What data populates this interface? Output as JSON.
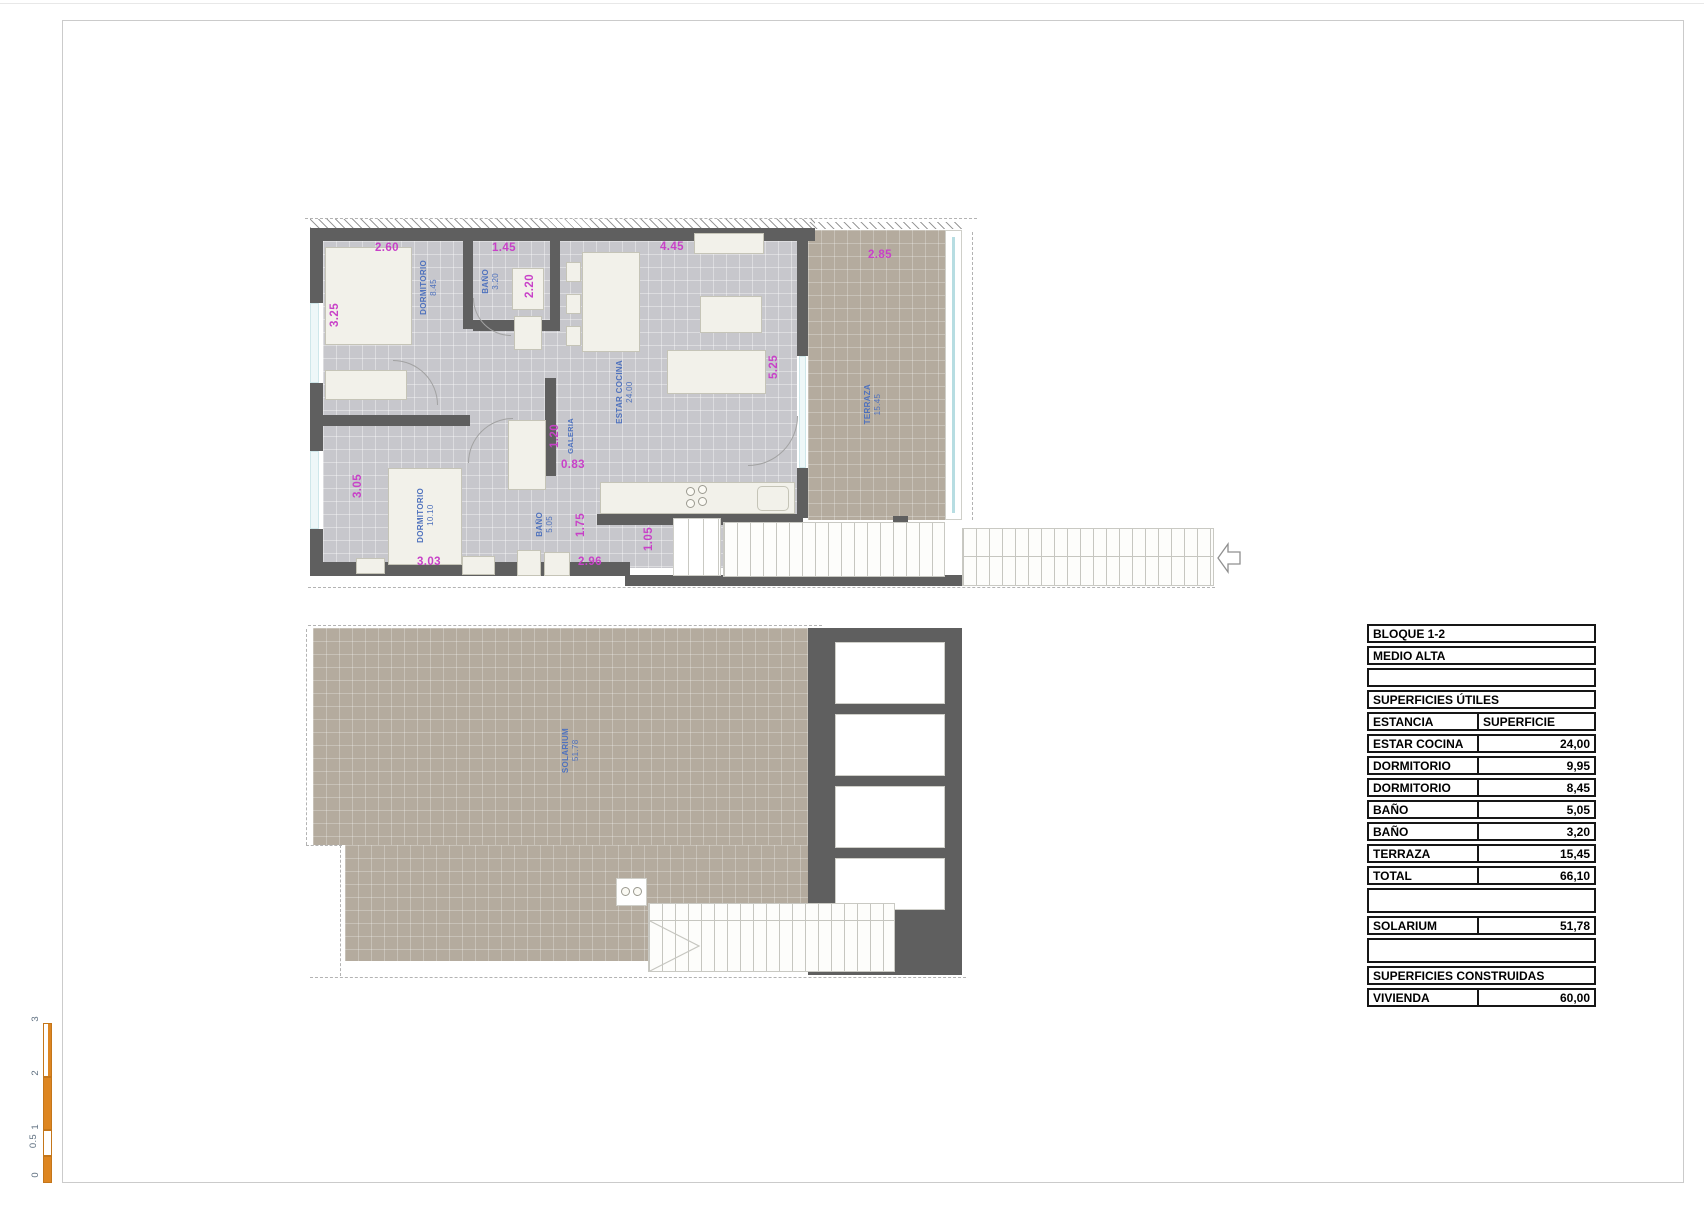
{
  "upper_plan": {
    "dims": {
      "w_dorm1": "2.60",
      "w_bath1": "1.45",
      "w_living": "4.45",
      "w_terrace": "2.85",
      "h_dorm1": "3.25",
      "h_bath1": "2.20",
      "h_living": "5.25",
      "h_dorm2": "3.05",
      "h_galeria": "1.20",
      "w_galeria": "0.83",
      "h_bath2": "1.75",
      "h_entry": "1.05",
      "w_dorm2": "3.03",
      "w_bath2": "2.96"
    },
    "rooms": {
      "dorm1": {
        "name": "DORMITORIO",
        "area": "8.45"
      },
      "bath1": {
        "name": "BAÑO",
        "area": "3.20"
      },
      "living": {
        "name": "ESTAR COCINA",
        "area": "24.00"
      },
      "terrace": {
        "name": "TERRAZA",
        "area": "15.45"
      },
      "dorm2": {
        "name": "DORMITORIO",
        "area": "10.10"
      },
      "bath2": {
        "name": "BAÑO",
        "area": "5.05"
      },
      "galeria": {
        "name": "GALERIA",
        "area": ""
      }
    }
  },
  "lower_plan": {
    "solarium": {
      "name": "SOLARIUM",
      "area": "51.78"
    }
  },
  "table": {
    "rows": [
      {
        "label": "BLOQUE 1-2",
        "value": ""
      },
      {
        "label": "MEDIO ALTA",
        "value": ""
      },
      {
        "label": "",
        "value": ""
      },
      {
        "label": "SUPERFICIES ÚTILES",
        "value": ""
      },
      {
        "label": "ESTANCIA",
        "value": "SUPERFICIE"
      },
      {
        "label": "ESTAR COCINA",
        "value": "24,00"
      },
      {
        "label": "DORMITORIO",
        "value": "9,95"
      },
      {
        "label": "DORMITORIO",
        "value": "8,45"
      },
      {
        "label": "BAÑO",
        "value": "5,05"
      },
      {
        "label": "BAÑO",
        "value": "3,20"
      },
      {
        "label": "TERRAZA",
        "value": "15,45"
      },
      {
        "label": "TOTAL",
        "value": "66,10"
      },
      {
        "label": "",
        "value": ""
      },
      {
        "label": "SOLARIUM",
        "value": "51,78"
      },
      {
        "label": "",
        "value": ""
      },
      {
        "label": "SUPERFICIES CONSTRUIDAS",
        "value": ""
      },
      {
        "label": "VIVIENDA",
        "value": "60,00"
      }
    ]
  },
  "scale_bar": {
    "labels": [
      "3",
      "2",
      "1",
      "0.5",
      "0"
    ]
  },
  "colors": {
    "wall": "#5f5f5f",
    "interior_floor": "#c7c7cc",
    "outdoor_floor": "#b4ab9e",
    "dimension_text": "#c841c8",
    "room_label_text": "#4f72bd",
    "scale_bar": "#dd8622"
  }
}
